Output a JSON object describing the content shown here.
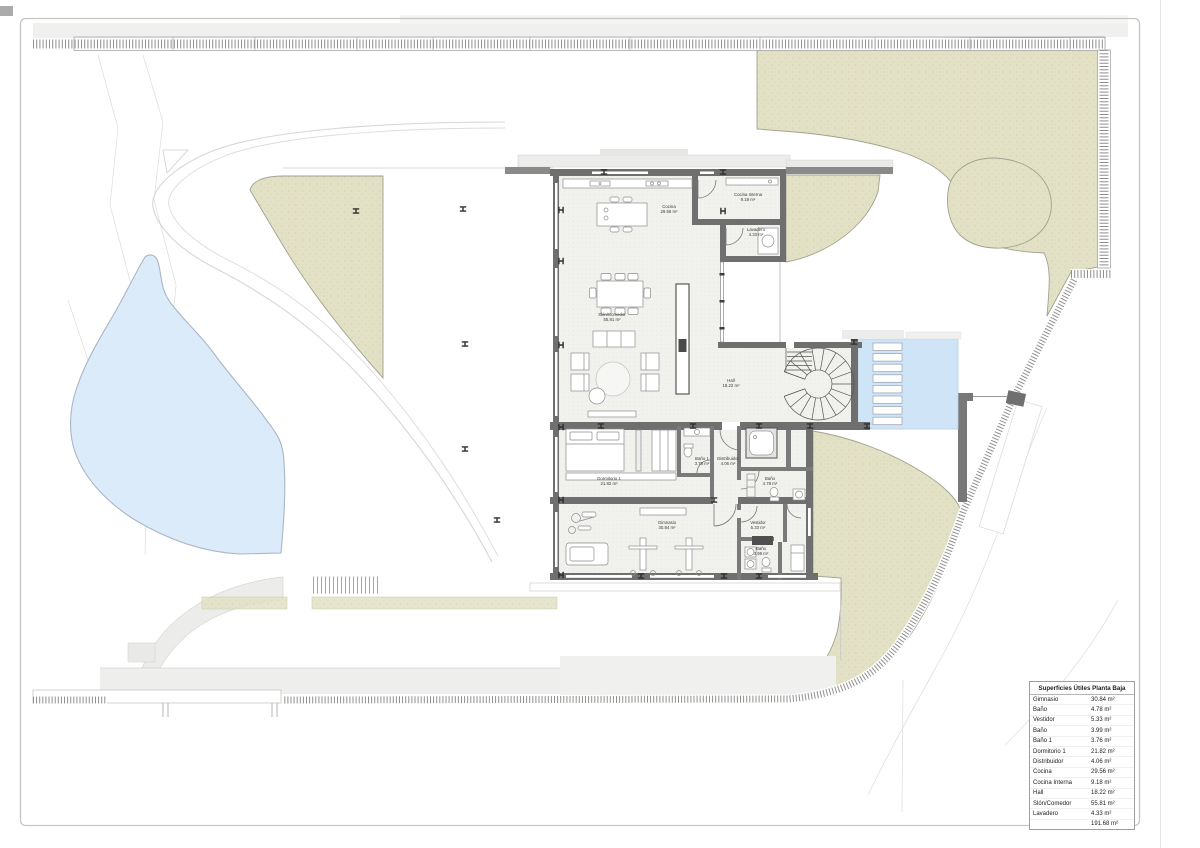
{
  "areas_table": {
    "title": "Superficies Útiles Planta Baja",
    "rows": [
      {
        "name": "Gimnasio",
        "value": "30.84 m²"
      },
      {
        "name": "Baño",
        "value": "4.78 m²"
      },
      {
        "name": "Vestidor",
        "value": "5.33 m²"
      },
      {
        "name": "Baño",
        "value": "3.99 m²"
      },
      {
        "name": "Baño 1",
        "value": "3.76 m²"
      },
      {
        "name": "Dormitorio 1",
        "value": "21.82 m²"
      },
      {
        "name": "Distribuidor",
        "value": "4.06 m²"
      },
      {
        "name": "Cocina",
        "value": "29.56 m²"
      },
      {
        "name": "Cocina Interna",
        "value": "9.18 m²"
      },
      {
        "name": "Hall",
        "value": "18.22 m²"
      },
      {
        "name": "Slón/Comedor",
        "value": "55.81 m²"
      },
      {
        "name": "Lavadero",
        "value": "4.33 m²"
      },
      {
        "name": "",
        "value": "191.68 m²"
      }
    ]
  },
  "rooms": [
    {
      "name": "Cocina",
      "area": "29.56 m²"
    },
    {
      "name": "Cocina Interna",
      "area": "9.18 m²"
    },
    {
      "name": "Lavadero",
      "area": "4.33 m²"
    },
    {
      "name": "Slón/Comedor",
      "area": "55.81 m²"
    },
    {
      "name": "Hall",
      "area": "18.22 m²"
    },
    {
      "name": "Dormitorio 1",
      "area": "21.82 m²"
    },
    {
      "name": "Baño 1",
      "area": "3.76 m²"
    },
    {
      "name": "Distribuidor",
      "area": "4.06 m²"
    },
    {
      "name": "Baño",
      "area": "4.78 m²"
    },
    {
      "name": "Gimnasio",
      "area": "30.84 m²"
    },
    {
      "name": "Vestidor",
      "area": "5.33 m²"
    },
    {
      "name": "Baño",
      "area": "3.99 m²"
    }
  ],
  "colors": {
    "wall": "#6f6f6f",
    "garden": "#e2e1c6",
    "pond": "#dcebfa",
    "pool": "#cfe4f6",
    "floor": "#f1f1ed"
  }
}
